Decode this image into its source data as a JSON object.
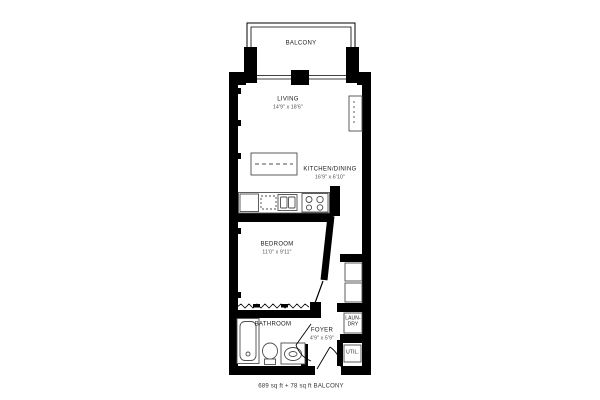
{
  "colors": {
    "wall": "#000000",
    "fixture_stroke": "#4d4d4d",
    "text": "#1a1a1a",
    "background": "#ffffff"
  },
  "plan": {
    "balcony": {
      "label": "BALCONY"
    },
    "living": {
      "label": "LIVING",
      "dims": "14'9\" x 18'6\""
    },
    "kitchen_dining": {
      "label": "KITCHEN/DINING",
      "dims": "16'9\" x 6'10\""
    },
    "bedroom": {
      "label": "BEDROOM",
      "dims": "11'0\" x 9'11\""
    },
    "bathroom": {
      "label": "BATHROOM"
    },
    "foyer": {
      "label": "FOYER",
      "dims": "4'9\" x 5'9\""
    },
    "laundry": {
      "line1": "LAUN-",
      "line2": "DRY"
    },
    "utility": {
      "label": "UTIL."
    },
    "caption": "689 sq ft + 78 sq ft BALCONY",
    "fixture_icons": [
      "balcony-railing",
      "window",
      "kitchen-island",
      "fridge",
      "dishwasher",
      "double-sink",
      "cooktop",
      "living-closet",
      "hall-closet",
      "laundry-closet",
      "utility-closet",
      "bathtub",
      "toilet",
      "vanity-sink",
      "entry-door",
      "bathroom-door",
      "bedroom-sliding-door",
      "closet-zigzag"
    ]
  }
}
